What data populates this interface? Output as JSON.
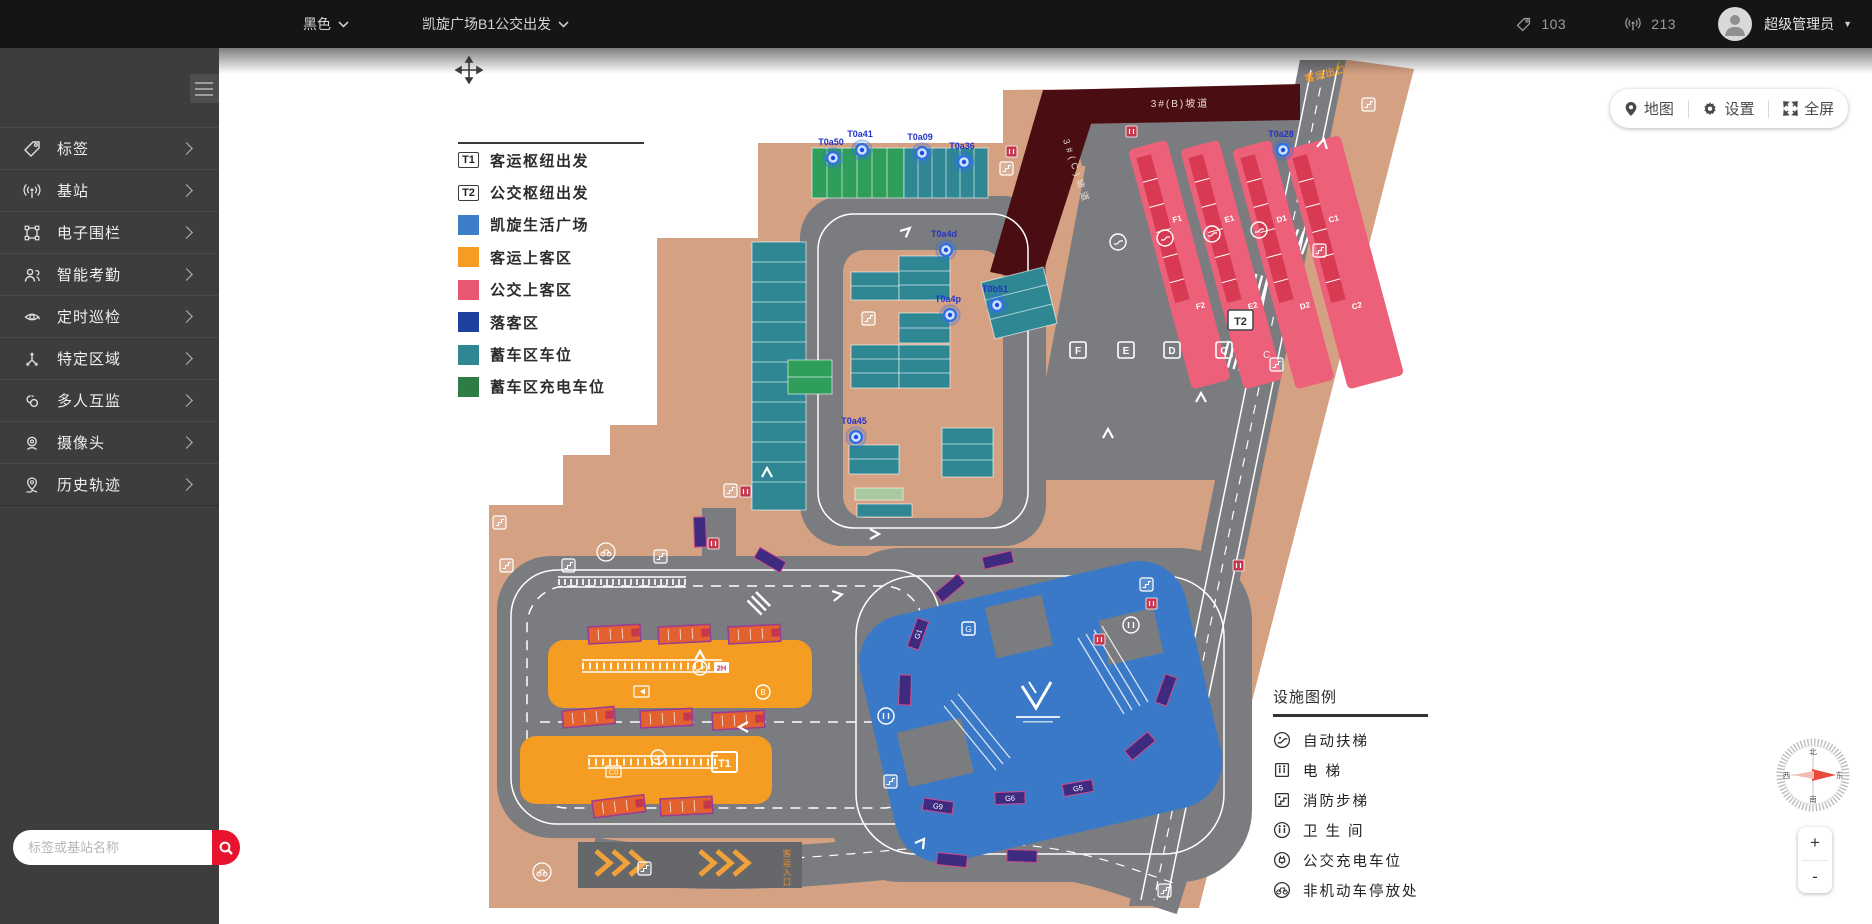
{
  "topbar": {
    "theme_selector": "黑色",
    "map_selector": "凯旋广场B1公交出发",
    "tag_count": "103",
    "station_count": "213",
    "user_name": "超级管理员"
  },
  "sidebar": {
    "items": [
      {
        "label": "标签",
        "icon": "tag-icon"
      },
      {
        "label": "基站",
        "icon": "antenna-icon"
      },
      {
        "label": "电子围栏",
        "icon": "fence-icon"
      },
      {
        "label": "智能考勤",
        "icon": "attendance-icon"
      },
      {
        "label": "定时巡检",
        "icon": "patrol-icon"
      },
      {
        "label": "特定区域",
        "icon": "area-icon"
      },
      {
        "label": "多人互监",
        "icon": "group-monitor-icon"
      },
      {
        "label": "摄像头",
        "icon": "camera-icon"
      },
      {
        "label": "历史轨迹",
        "icon": "history-track-icon"
      }
    ],
    "search_placeholder": "标签或基站名称"
  },
  "map_toolbar": {
    "map_label": "地图",
    "settings_label": "设置",
    "fullscreen_label": "全屏"
  },
  "map_legend": {
    "items": [
      {
        "chip": "T1",
        "label": "客运枢纽出发"
      },
      {
        "chip": "T2",
        "label": "公交枢纽出发"
      },
      {
        "color": "#3e7dc8",
        "label": "凯旋生活广场",
        "striped": false
      },
      {
        "color": "#f79b23",
        "label": "客运上客区",
        "striped": false
      },
      {
        "color": "#e95672",
        "label": "公交上客区",
        "striped": false
      },
      {
        "color": "#1d3f9e",
        "label": "落客区",
        "striped": false
      },
      {
        "color": "#2e8793",
        "label": "蓄车区车位",
        "striped": true
      },
      {
        "color": "#2e7d46",
        "label": "蓄车区充电车位",
        "striped": true
      }
    ]
  },
  "facility_legend": {
    "title": "设施图例",
    "items": [
      {
        "icon": "escalator-icon",
        "label": "自动扶梯"
      },
      {
        "icon": "elevator-icon",
        "label": "电 梯"
      },
      {
        "icon": "fire-stairs-icon",
        "label": "消防步梯"
      },
      {
        "icon": "toilet-icon",
        "label": "卫 生 间"
      },
      {
        "icon": "bus-charging-icon",
        "label": "公交充电车位"
      },
      {
        "icon": "bicycle-parking-icon",
        "label": "非机动车停放处"
      }
    ]
  },
  "map_annotations": {
    "ramp_b": "3#(B)坡道",
    "ramp_c": "3#(C)坡道",
    "exit_label": "客运出口",
    "entrance_label": "客运入口",
    "t1_label": "T1",
    "t2_label": "T2",
    "plain_c_label": "C",
    "bay_labels": [
      "F",
      "E",
      "D",
      "C"
    ],
    "bay_sub_labels": [
      "F1",
      "F2",
      "E1",
      "E2",
      "D1",
      "D2",
      "C1",
      "C2"
    ],
    "g_box_label": "G",
    "g_stop_labels": [
      "G1",
      "G5",
      "G6",
      "G9"
    ],
    "badge_2h": "2H",
    "badge_c0": "C0",
    "badge_b": "B",
    "pins": [
      "T0a50",
      "T0a41",
      "T0a09",
      "T0a36",
      "T0a4d",
      "T0a4p",
      "T0a45",
      "T0b51",
      "T0a28"
    ],
    "compass": {
      "north": "北",
      "south": "南",
      "east": "东",
      "west": "西"
    }
  },
  "zoom_controls": {
    "zoom_in": "+",
    "zoom_out": "-"
  }
}
